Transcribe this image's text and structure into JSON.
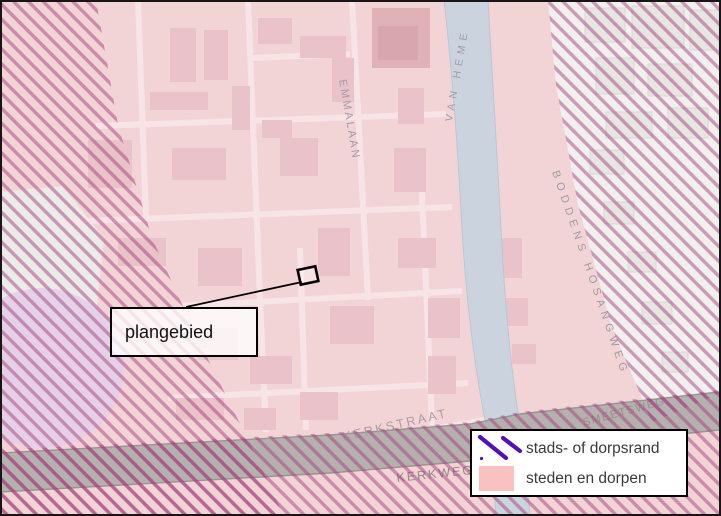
{
  "map": {
    "callout_label": "plangebied",
    "street_labels": [
      {
        "id": "emmalaan",
        "text": "EMMALAAN"
      },
      {
        "id": "van-heme",
        "text": "VAN HEME"
      },
      {
        "id": "boddens-hosangweg",
        "text": "BODDENS HOSANGWEG"
      },
      {
        "id": "kerkstraat",
        "text": "KERKSTRAAT"
      },
      {
        "id": "kerkweg",
        "text": "KERKWEG"
      },
      {
        "id": "smeetsweg",
        "text": "SMEETSWEG"
      }
    ]
  },
  "legend": {
    "items": [
      {
        "symbol": "purple-diagonal-hatch",
        "label": "stads- of dorpsrand"
      },
      {
        "symbol": "pink-fill-swatch",
        "label": "steden en dorpen"
      }
    ]
  },
  "colors": {
    "steden_en_dorpen": "#f9c2c1",
    "map_pink": "#f2d4d7",
    "hatch_stripe": "#a3407c",
    "dorpsrand_purple": "#5212b2",
    "canal_blue": "#cbd3df",
    "road_gray": "#b1afad",
    "legend_text": "#3a3a3a"
  }
}
